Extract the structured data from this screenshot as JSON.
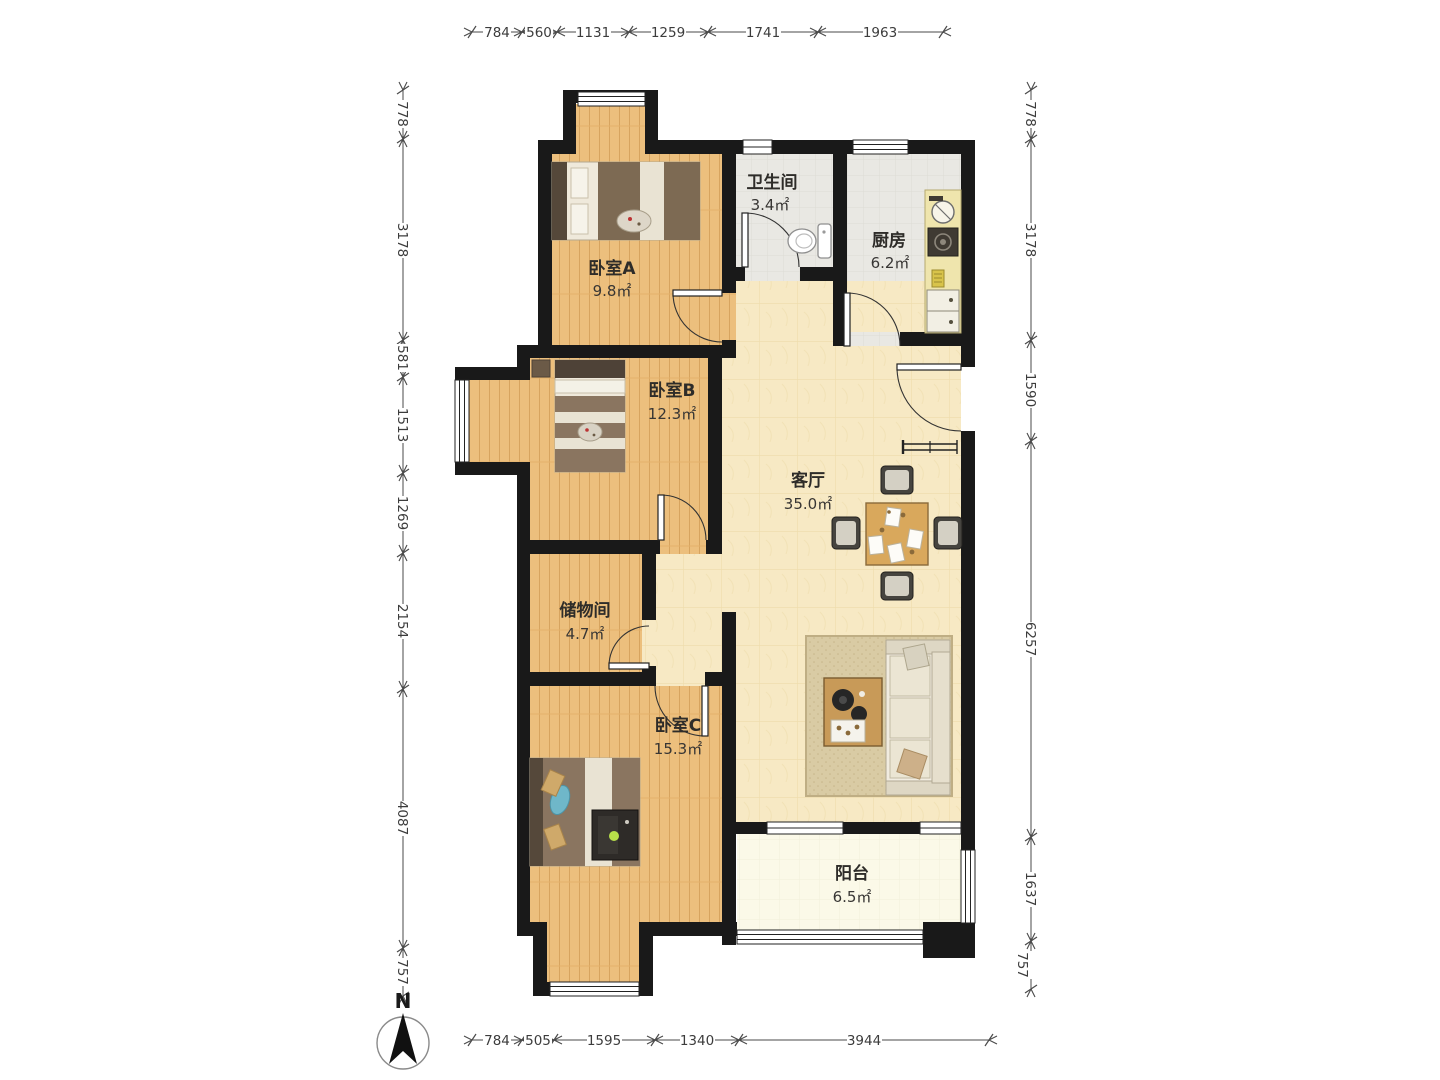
{
  "compass": {
    "label": "N"
  },
  "rooms": [
    {
      "id": "bedroom-a",
      "name": "卧室A",
      "area": "9.8㎡"
    },
    {
      "id": "bathroom",
      "name": "卫生间",
      "area": "3.4㎡"
    },
    {
      "id": "kitchen",
      "name": "厨房",
      "area": "6.2㎡"
    },
    {
      "id": "bedroom-b",
      "name": "卧室B",
      "area": "12.3㎡"
    },
    {
      "id": "living-room",
      "name": "客厅",
      "area": "35.0㎡"
    },
    {
      "id": "storage",
      "name": "储物间",
      "area": "4.7㎡"
    },
    {
      "id": "bedroom-c",
      "name": "卧室C",
      "area": "15.3㎡"
    },
    {
      "id": "balcony",
      "name": "阳台",
      "area": "6.5㎡"
    }
  ],
  "dimensions": {
    "top": [
      "784",
      "560",
      "1131",
      "1259",
      "1741",
      "1963"
    ],
    "bottom": [
      "784",
      "505",
      "1595",
      "1340",
      "3944"
    ],
    "left": [
      "778",
      "3178",
      "581",
      "1513",
      "1269",
      "2154",
      "4087",
      "757"
    ],
    "right": [
      "778",
      "3178",
      "1590",
      "6257",
      "1637",
      "757"
    ]
  }
}
